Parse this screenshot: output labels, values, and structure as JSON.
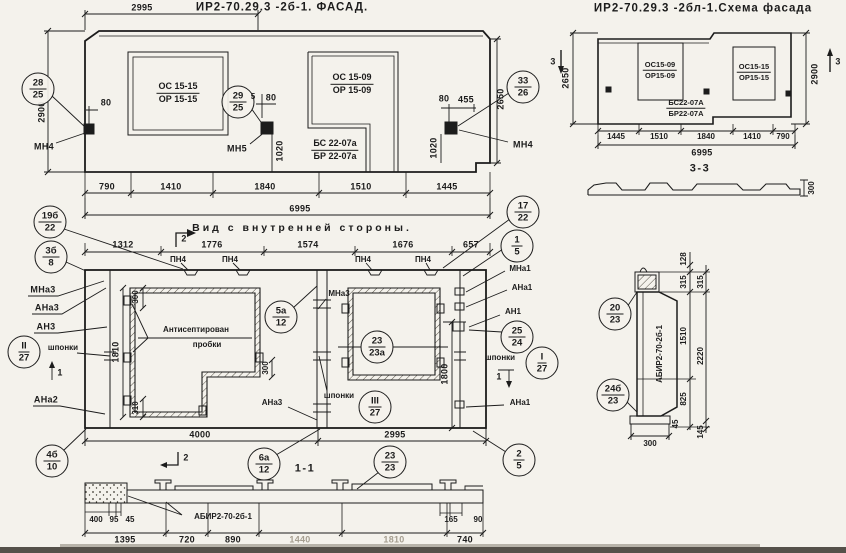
{
  "facade": {
    "title": "ИР2-70.29.3 -2б-1. ФАСАД.",
    "d2995": "2995",
    "d2900": "2900",
    "d2650": "2650",
    "co28_t": "28",
    "co28_b": "25",
    "co29_t": "29",
    "co29_b": "25",
    "co33_t": "33",
    "co33_b": "26",
    "mn4": "МН4",
    "mn5": "МН5",
    "win_left_1": "ОС 15-15",
    "win_left_2": "ОР 15-15",
    "win_right_1": "ОС 15-09",
    "win_right_2": "ОР 15-09",
    "block_1": "БС 22-07а",
    "block_2": "БР 22-07а",
    "d80": "80",
    "d5": "5",
    "d455": "455",
    "d1020": "1020",
    "row": {
      "r1": "790",
      "r2": "1410",
      "r3": "1840",
      "r4": "1510",
      "r5": "1445"
    },
    "total": "6995"
  },
  "scheme": {
    "title": "ИР2-70.29.3 -2бл-1.Схема фасада",
    "win_left_1": "ОС15-09",
    "win_left_2": "ОР15-09",
    "win_right_1": "ОС15-15",
    "win_right_2": "ОР15-15",
    "block_1": "БС22-07А",
    "block_2": "БР22-07А",
    "d2650": "2650",
    "d2900": "2900",
    "mark3": "3",
    "row": {
      "r1": "1445",
      "r2": "1510",
      "r3": "1840",
      "r4": "1410",
      "r5": "790"
    },
    "total": "6995",
    "section_label": "3-3",
    "d300": "300"
  },
  "inner": {
    "title": "Вид с внутренней стороны.",
    "mark1": "1",
    "mark2": "2",
    "top": {
      "d1": "1312",
      "d2": "1776",
      "d3": "1574",
      "d4": "1676",
      "d5": "657"
    },
    "pn4": "ПН4",
    "co19b_t": "19б",
    "co19b_b": "22",
    "co3b_t": "3б",
    "co3b_b": "8",
    "coII_t": "II",
    "coII_b": "27",
    "coIII_t": "III",
    "coIII_b": "27",
    "coI_t": "I",
    "coI_b": "27",
    "mna3": "МНа3",
    "ana3": "АНа3",
    "an3": "АН3",
    "shponki": "шпонки",
    "ana2": "АНа2",
    "mna1": "МНа1",
    "ana1": "АНа1",
    "an1": "АН1",
    "co5a_t": "5а",
    "co5a_b": "12",
    "co23_t": "23",
    "co23_b": "23а",
    "co17_t": "17",
    "co17_b": "22",
    "co15_t": "1",
    "co15_b": "5",
    "co2524_t": "25",
    "co2524_b": "24",
    "co25_t": "2",
    "co25_b": "5",
    "co4b_t": "4б",
    "co4b_b": "10",
    "plugs1": "Антисептирован",
    "plugs2": "пробки",
    "d300": "300",
    "d1810": "1810",
    "d310": "310",
    "d1800": "1800",
    "d4000": "4000",
    "d2995": "2995"
  },
  "s11": {
    "label": "1-1",
    "part": "АБИР2-70-2б-1",
    "co6a_t": "6а",
    "co6a_b": "12",
    "co23_t": "23",
    "co23_b": "23",
    "d400": "400",
    "d95": "95",
    "d45": "45",
    "d1395": "1395",
    "d720": "720",
    "d890": "890",
    "d1440": "1440",
    "d1810": "1810",
    "d740": "740",
    "d165": "165",
    "d90": "90"
  },
  "s22": {
    "part": "АБИР2-70-2б-1",
    "co20_t": "20",
    "co20_b": "23",
    "co24b_t": "24б",
    "co24b_b": "23",
    "d128": "128",
    "d315": "315",
    "d1510": "1510",
    "d2220": "2220",
    "d825": "825",
    "d45": "45",
    "d145": "145",
    "d300": "300"
  }
}
